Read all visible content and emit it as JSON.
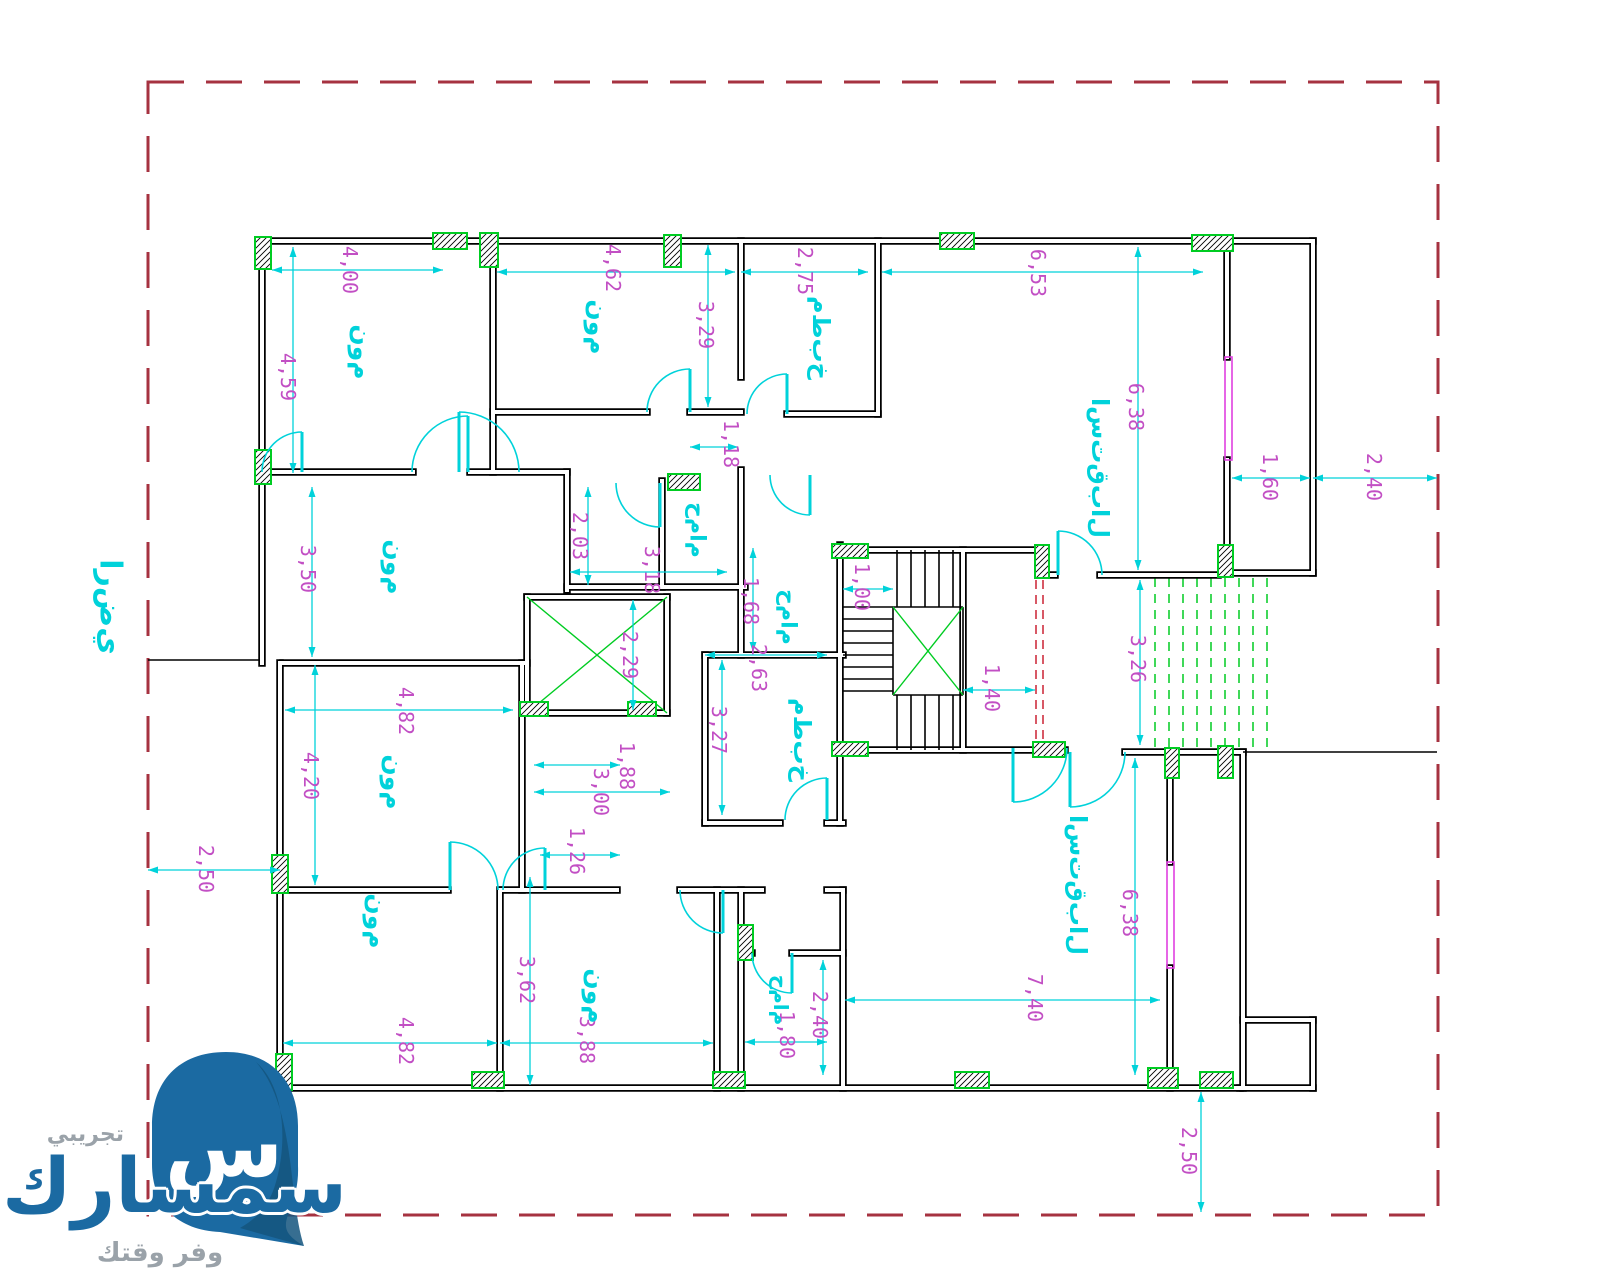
{
  "watermark": {
    "logo_glyph": "س",
    "brand": "سمسارك",
    "trial": "تجريبي",
    "tagline": "وفر وقتك"
  },
  "colors": {
    "wall": "#000000",
    "wall_core": "#ffffff",
    "boundary": "#a63240",
    "cyan": "#00d2da",
    "magenta": "#c24fc4",
    "green": "#00cc22",
    "red_dash": "#cc2233",
    "window": "#e040e0",
    "logo_blue": "#1b6aa2",
    "logo_blue_dark": "#14557e"
  },
  "boundary": {
    "x": 148,
    "y": 82,
    "w": 1290,
    "h": 1133
  },
  "site": {
    "label_key": "ground",
    "x": 110,
    "y": 607,
    "size": 30,
    "line": [
      148,
      660,
      262,
      660
    ]
  },
  "label_texts": {
    "bedroom": "م‌و‌ن",
    "kitchen": "خ‌ب‌ط‌م",
    "bathroom": "م‌ا‌م‌ح",
    "reception": "ل‌ا‌ب‌ق‌ت‌س‌ا",
    "ground": "ي‌ض‌ر‌ا"
  },
  "walls": [
    [
      262,
      241,
      1313,
      241
    ],
    [
      262,
      241,
      262,
      663
    ],
    [
      280,
      663,
      280,
      1088
    ],
    [
      280,
      1088,
      1240,
      1088
    ],
    [
      1313,
      241,
      1313,
      573
    ],
    [
      1227,
      250,
      1227,
      357
    ],
    [
      1227,
      460,
      1227,
      573
    ],
    [
      1227,
      573,
      1313,
      573
    ],
    [
      493,
      241,
      493,
      472
    ],
    [
      262,
      472,
      413,
      472
    ],
    [
      470,
      472,
      567,
      472
    ],
    [
      493,
      412,
      647,
      412
    ],
    [
      690,
      412,
      741,
      412
    ],
    [
      741,
      241,
      741,
      377
    ],
    [
      787,
      414,
      878,
      414
    ],
    [
      878,
      241,
      878,
      414
    ],
    [
      567,
      472,
      567,
      590
    ],
    [
      567,
      587,
      745,
      587
    ],
    [
      662,
      481,
      662,
      587
    ],
    [
      741,
      470,
      741,
      655
    ],
    [
      527,
      597,
      667,
      597
    ],
    [
      527,
      597,
      527,
      713
    ],
    [
      667,
      597,
      667,
      713
    ],
    [
      527,
      713,
      667,
      713
    ],
    [
      283,
      663,
      527,
      663
    ],
    [
      705,
      655,
      843,
      655
    ],
    [
      705,
      655,
      705,
      823
    ],
    [
      705,
      823,
      780,
      823
    ],
    [
      827,
      823,
      843,
      823
    ],
    [
      840,
      545,
      840,
      823
    ],
    [
      840,
      550,
      1037,
      550
    ],
    [
      840,
      750,
      1065,
      750
    ],
    [
      963,
      550,
      963,
      750
    ],
    [
      1047,
      575,
      1055,
      575
    ],
    [
      1100,
      575,
      1218,
      575
    ],
    [
      1125,
      752,
      1165,
      752
    ],
    [
      1177,
      752,
      1243,
      752
    ],
    [
      1170,
      777,
      1170,
      862
    ],
    [
      1170,
      968,
      1170,
      1088
    ],
    [
      1243,
      752,
      1243,
      1088
    ],
    [
      1243,
      1020,
      1313,
      1020
    ],
    [
      1313,
      1020,
      1313,
      1088
    ],
    [
      1240,
      1088,
      1313,
      1088
    ],
    [
      280,
      890,
      448,
      890
    ],
    [
      503,
      890,
      617,
      890
    ],
    [
      680,
      890,
      762,
      890
    ],
    [
      827,
      890,
      843,
      890
    ],
    [
      500,
      890,
      500,
      1088
    ],
    [
      522,
      663,
      522,
      890
    ],
    [
      717,
      890,
      717,
      1088
    ],
    [
      741,
      890,
      741,
      1088
    ],
    [
      741,
      953,
      752,
      953
    ],
    [
      792,
      953,
      843,
      953
    ],
    [
      843,
      890,
      843,
      1088
    ]
  ],
  "thin_lines": [
    [
      843,
      607,
      893,
      607
    ],
    [
      843,
      619,
      893,
      619
    ],
    [
      843,
      631,
      893,
      631
    ],
    [
      843,
      643,
      893,
      643
    ],
    [
      843,
      655,
      893,
      655
    ],
    [
      843,
      667,
      893,
      667
    ],
    [
      843,
      679,
      893,
      679
    ],
    [
      843,
      691,
      893,
      691
    ],
    [
      897,
      550,
      897,
      607
    ],
    [
      911,
      550,
      911,
      607
    ],
    [
      925,
      550,
      925,
      607
    ],
    [
      939,
      550,
      939,
      607
    ],
    [
      953,
      550,
      953,
      607
    ],
    [
      897,
      695,
      897,
      750
    ],
    [
      911,
      695,
      911,
      750
    ],
    [
      925,
      695,
      925,
      750
    ],
    [
      939,
      695,
      939,
      750
    ],
    [
      953,
      695,
      953,
      750
    ],
    [
      893,
      607,
      963,
      607
    ],
    [
      893,
      695,
      963,
      695
    ],
    [
      893,
      607,
      893,
      695
    ],
    [
      963,
      607,
      963,
      695
    ],
    [
      1243,
      752,
      1437,
      752
    ]
  ],
  "green_lines": [
    [
      527,
      597,
      667,
      713
    ],
    [
      527,
      713,
      667,
      597
    ],
    [
      893,
      607,
      963,
      695
    ],
    [
      893,
      695,
      963,
      607
    ]
  ],
  "green_dashed": [
    [
      1155,
      578,
      1155,
      748
    ],
    [
      1169,
      578,
      1169,
      748
    ],
    [
      1183,
      578,
      1183,
      748
    ],
    [
      1197,
      578,
      1197,
      748
    ],
    [
      1211,
      578,
      1211,
      748
    ],
    [
      1225,
      578,
      1225,
      748
    ],
    [
      1239,
      578,
      1239,
      748
    ],
    [
      1253,
      578,
      1253,
      748
    ],
    [
      1267,
      578,
      1267,
      748
    ]
  ],
  "red_dashed": [
    [
      1036,
      580,
      1036,
      745
    ],
    [
      1043,
      580,
      1043,
      745
    ]
  ],
  "windows": [
    [
      1225,
      357,
      7,
      103
    ],
    [
      1167,
      862,
      7,
      106
    ]
  ],
  "columns": [
    [
      255,
      237,
      16,
      32
    ],
    [
      433,
      233,
      34,
      16
    ],
    [
      480,
      233,
      18,
      34
    ],
    [
      664,
      235,
      17,
      32
    ],
    [
      940,
      233,
      34,
      16
    ],
    [
      1192,
      235,
      41,
      16
    ],
    [
      255,
      450,
      16,
      34
    ],
    [
      272,
      855,
      16,
      38
    ],
    [
      276,
      1054,
      16,
      36
    ],
    [
      472,
      1072,
      32,
      16
    ],
    [
      713,
      1072,
      32,
      16
    ],
    [
      955,
      1072,
      34,
      16
    ],
    [
      1148,
      1068,
      30,
      20
    ],
    [
      1200,
      1072,
      33,
      16
    ],
    [
      668,
      474,
      32,
      16
    ],
    [
      832,
      544,
      36,
      14
    ],
    [
      832,
      742,
      36,
      14
    ],
    [
      520,
      702,
      28,
      14
    ],
    [
      628,
      702,
      28,
      14
    ],
    [
      1035,
      545,
      14,
      33
    ],
    [
      1218,
      545,
      15,
      32
    ],
    [
      1218,
      746,
      15,
      32
    ],
    [
      1033,
      742,
      32,
      15
    ],
    [
      1165,
      748,
      14,
      30
    ],
    [
      738,
      925,
      15,
      35
    ]
  ],
  "doors": [
    [
      468,
      472,
      56,
      180,
      270
    ],
    [
      690,
      412,
      43,
      180,
      270
    ],
    [
      459,
      472,
      60,
      0,
      270
    ],
    [
      660,
      483,
      44,
      180,
      90
    ],
    [
      787,
      414,
      40,
      180,
      270
    ],
    [
      810,
      475,
      40,
      180,
      90
    ],
    [
      1058,
      575,
      44,
      0,
      270
    ],
    [
      1070,
      752,
      55,
      0,
      90
    ],
    [
      1013,
      748,
      54,
      0,
      90
    ],
    [
      827,
      820,
      42,
      180,
      270
    ],
    [
      450,
      890,
      48,
      0,
      270
    ],
    [
      545,
      890,
      42,
      180,
      270
    ],
    [
      723,
      890,
      43,
      180,
      90
    ],
    [
      792,
      953,
      40,
      180,
      90
    ],
    [
      302,
      472,
      40,
      180,
      270
    ]
  ],
  "dimensions": [
    {
      "l": [
        272,
        270,
        443,
        270
      ],
      "t": [
        350,
        270
      ],
      "v": "4,00"
    },
    {
      "l": [
        293,
        247,
        293,
        473
      ],
      "t": [
        288,
        377
      ],
      "v": "4,59"
    },
    {
      "l": [
        497,
        272,
        735,
        272
      ],
      "t": [
        613,
        268
      ],
      "v": "4,62"
    },
    {
      "l": [
        708,
        245,
        708,
        407
      ],
      "t": [
        706,
        325
      ],
      "v": "3,29"
    },
    {
      "l": [
        741,
        272,
        868,
        272
      ],
      "t": [
        805,
        271
      ],
      "v": "2,75"
    },
    {
      "l": [
        882,
        272,
        1203,
        272
      ],
      "t": [
        1038,
        273
      ],
      "v": "6,53"
    },
    {
      "l": [
        1138,
        247,
        1138,
        570
      ],
      "t": [
        1136,
        407
      ],
      "v": "6,38"
    },
    {
      "l": [
        690,
        447,
        738,
        447
      ],
      "t": [
        731,
        444
      ],
      "v": "1,18"
    },
    {
      "l": [
        588,
        487,
        588,
        585
      ],
      "t": [
        580,
        536
      ],
      "v": "2,03"
    },
    {
      "l": [
        570,
        572,
        727,
        572
      ],
      "t": [
        652,
        570
      ],
      "v": "3,18"
    },
    {
      "l": [
        753,
        548,
        753,
        652
      ],
      "t": [
        751,
        601
      ],
      "v": "1,68"
    },
    {
      "l": [
        633,
        600,
        633,
        710
      ],
      "t": [
        630,
        655
      ],
      "v": "2,29"
    },
    {
      "l": [
        843,
        589,
        893,
        589
      ],
      "t": [
        862,
        587
      ],
      "v": "1,00"
    },
    {
      "l": [
        963,
        690,
        1035,
        690
      ],
      "t": [
        992,
        688
      ],
      "v": "1,40"
    },
    {
      "l": [
        1140,
        580,
        1140,
        745
      ],
      "t": [
        1138,
        659
      ],
      "v": "3,26"
    },
    {
      "l": [
        1232,
        478,
        1310,
        478
      ],
      "t": [
        1270,
        477
      ],
      "v": "1,60"
    },
    {
      "l": [
        1313,
        478,
        1437,
        478
      ],
      "t": [
        1374,
        477
      ],
      "v": "2,40"
    },
    {
      "l": [
        312,
        487,
        312,
        657
      ],
      "t": [
        308,
        569
      ],
      "v": "3,50"
    },
    {
      "l": [
        285,
        710,
        513,
        710
      ],
      "t": [
        406,
        711
      ],
      "v": "4,82"
    },
    {
      "l": [
        315,
        665,
        315,
        885
      ],
      "t": [
        311,
        776
      ],
      "v": "4,20"
    },
    {
      "l": [
        148,
        870,
        280,
        870
      ],
      "t": [
        206,
        869
      ],
      "v": "2,50"
    },
    {
      "l": [
        283,
        1043,
        497,
        1043
      ],
      "t": [
        406,
        1041
      ],
      "v": "4,82"
    },
    {
      "l": [
        530,
        877,
        530,
        1085
      ],
      "t": [
        527,
        980
      ],
      "v": "3,62"
    },
    {
      "l": [
        500,
        1043,
        713,
        1043
      ],
      "t": [
        587,
        1040
      ],
      "v": "3,88"
    },
    {
      "l": [
        540,
        855,
        620,
        855
      ],
      "t": [
        577,
        851
      ],
      "v": "1,26"
    },
    {
      "l": [
        534,
        765,
        620,
        765
      ],
      "t": [
        627,
        766
      ],
      "v": "1,88"
    },
    {
      "l": [
        534,
        792,
        670,
        792
      ],
      "t": [
        601,
        792
      ],
      "v": "3,00"
    },
    {
      "l": [
        705,
        655,
        827,
        655
      ],
      "t": [
        759,
        668
      ],
      "v": "2,63"
    },
    {
      "l": [
        722,
        660,
        722,
        815
      ],
      "t": [
        719,
        730
      ],
      "v": "3,27"
    },
    {
      "l": [
        823,
        960,
        823,
        1075
      ],
      "t": [
        820,
        1015
      ],
      "v": "2,40"
    },
    {
      "l": [
        745,
        1042,
        827,
        1042
      ],
      "t": [
        787,
        1035
      ],
      "v": "1,80"
    },
    {
      "l": [
        845,
        1000,
        1160,
        1000
      ],
      "t": [
        1035,
        998
      ],
      "v": "7,40"
    },
    {
      "l": [
        1135,
        758,
        1135,
        1075
      ],
      "t": [
        1130,
        913
      ],
      "v": "6,38"
    },
    {
      "l": [
        1201,
        1092,
        1201,
        1212
      ],
      "t": [
        1189,
        1151
      ],
      "v": "2,50"
    }
  ],
  "room_labels": [
    {
      "x": 362,
      "y": 352,
      "key": "bedroom",
      "size": 25
    },
    {
      "x": 598,
      "y": 327,
      "key": "bedroom",
      "size": 25
    },
    {
      "x": 821,
      "y": 338,
      "key": "kitchen",
      "size": 24
    },
    {
      "x": 1100,
      "y": 468,
      "key": "reception",
      "size": 24
    },
    {
      "x": 697,
      "y": 530,
      "key": "bathroom",
      "size": 22
    },
    {
      "x": 788,
      "y": 617,
      "key": "bathroom",
      "size": 22
    },
    {
      "x": 395,
      "y": 567,
      "key": "bedroom",
      "size": 25
    },
    {
      "x": 394,
      "y": 782,
      "key": "bedroom",
      "size": 25
    },
    {
      "x": 377,
      "y": 921,
      "key": "bedroom",
      "size": 25
    },
    {
      "x": 596,
      "y": 996,
      "key": "bedroom",
      "size": 25
    },
    {
      "x": 802,
      "y": 740,
      "key": "kitchen",
      "size": 24
    },
    {
      "x": 781,
      "y": 1000,
      "key": "bathroom",
      "size": 20
    },
    {
      "x": 1078,
      "y": 885,
      "key": "reception",
      "size": 24
    }
  ]
}
